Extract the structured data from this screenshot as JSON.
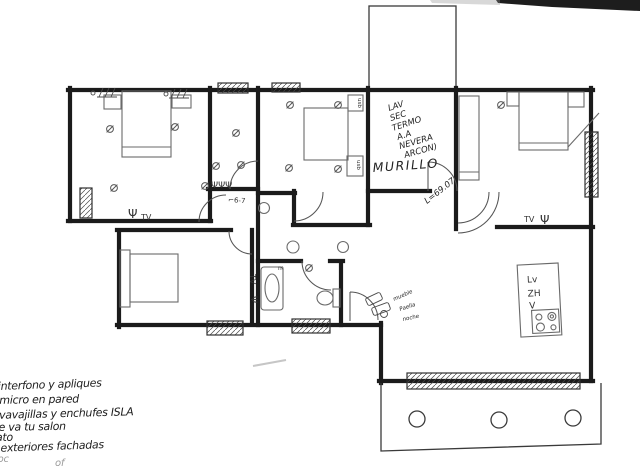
{
  "annotations": {
    "utility_list": [
      "LAV",
      "SEC",
      "TERMO",
      "A.A",
      "NEVERA",
      "ARCON)"
    ],
    "murillo": "MURILLO",
    "door_dim": "L=69.07",
    "hall_symbol": "⌐6-7",
    "switches": "ΨΨΨ",
    "kitchen_notes": [
      "mueble",
      "Paella",
      "noche"
    ]
  },
  "labels": {
    "tv_bedroom1": "TV",
    "tv_bedroom3": "TV",
    "tv_bedroom4": "TV",
    "psi": "Ψ",
    "usb": "usb",
    "mirror": "m",
    "island": {
      "lv": "Lv",
      "zh": "ZH",
      "v": "V"
    }
  },
  "notes": {
    "lines": [
      "interfono y apliques",
      "y micro en pared",
      "lavavajillas y enchufes ISLA",
      "de va tu salon",
      "ato",
      "s exteriores fachadas"
    ],
    "faint": [
      "toc",
      "of"
    ]
  },
  "colors": {
    "ink": "#1b1b1b",
    "pencil": "#6a6a6a",
    "paper": "#ffffff"
  }
}
